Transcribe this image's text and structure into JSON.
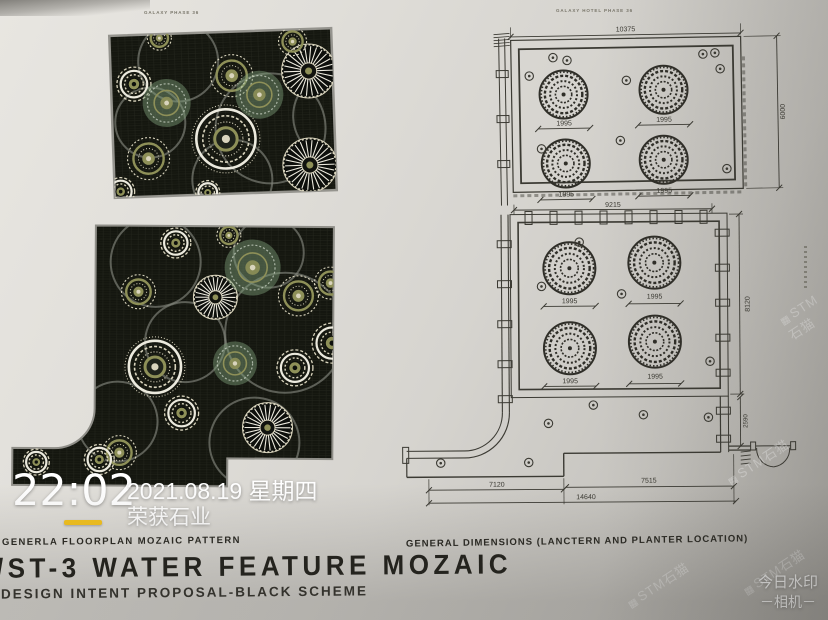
{
  "page": {
    "left_header": "GALAXY PHASE 36",
    "right_header": "GALAXY HOTEL PHASE 36",
    "left_caption": "GENERLA FLOORPLAN MOZAIC PATTERN",
    "left_title": "/ST-3 WATER FEATURE MOZAIC",
    "left_subtitle": "DESIGN INTENT PROPOSAL-BLACK SCHEME",
    "right_caption": "GENERAL DIMENSIONS (LANCTERN AND PLANTER LOCATION)"
  },
  "plans": {
    "upper": {
      "top_dim": "10375",
      "right_dim": "6000",
      "planter_dim": "1995"
    },
    "lower": {
      "top_dim": "9215",
      "right_dim": "8120",
      "planter_dim": "1995",
      "bottom_left_dim": "7120",
      "bottom_right_dim": "7515",
      "bottom_total_dim": "14640",
      "right_lower_dim": "2590"
    }
  },
  "watermark": {
    "time": "22:02",
    "date": "2021.08.19 星期四",
    "company": "荣获石业",
    "underline_color": "#f6c41e",
    "app_line1": "今日水印",
    "app_line2": "－相机－",
    "diagonal_text": "STM石猫"
  },
  "colors": {
    "paper": "#dcdad5",
    "ink": "#3b3a33",
    "mosaic_bg": "#14160f",
    "cream": "#d9d4bd",
    "white": "#eceade",
    "olive": "#8e9058",
    "green": "#7ea07a",
    "gray_ring": "#83857c",
    "watermark_yellow": "#f6c41e"
  }
}
